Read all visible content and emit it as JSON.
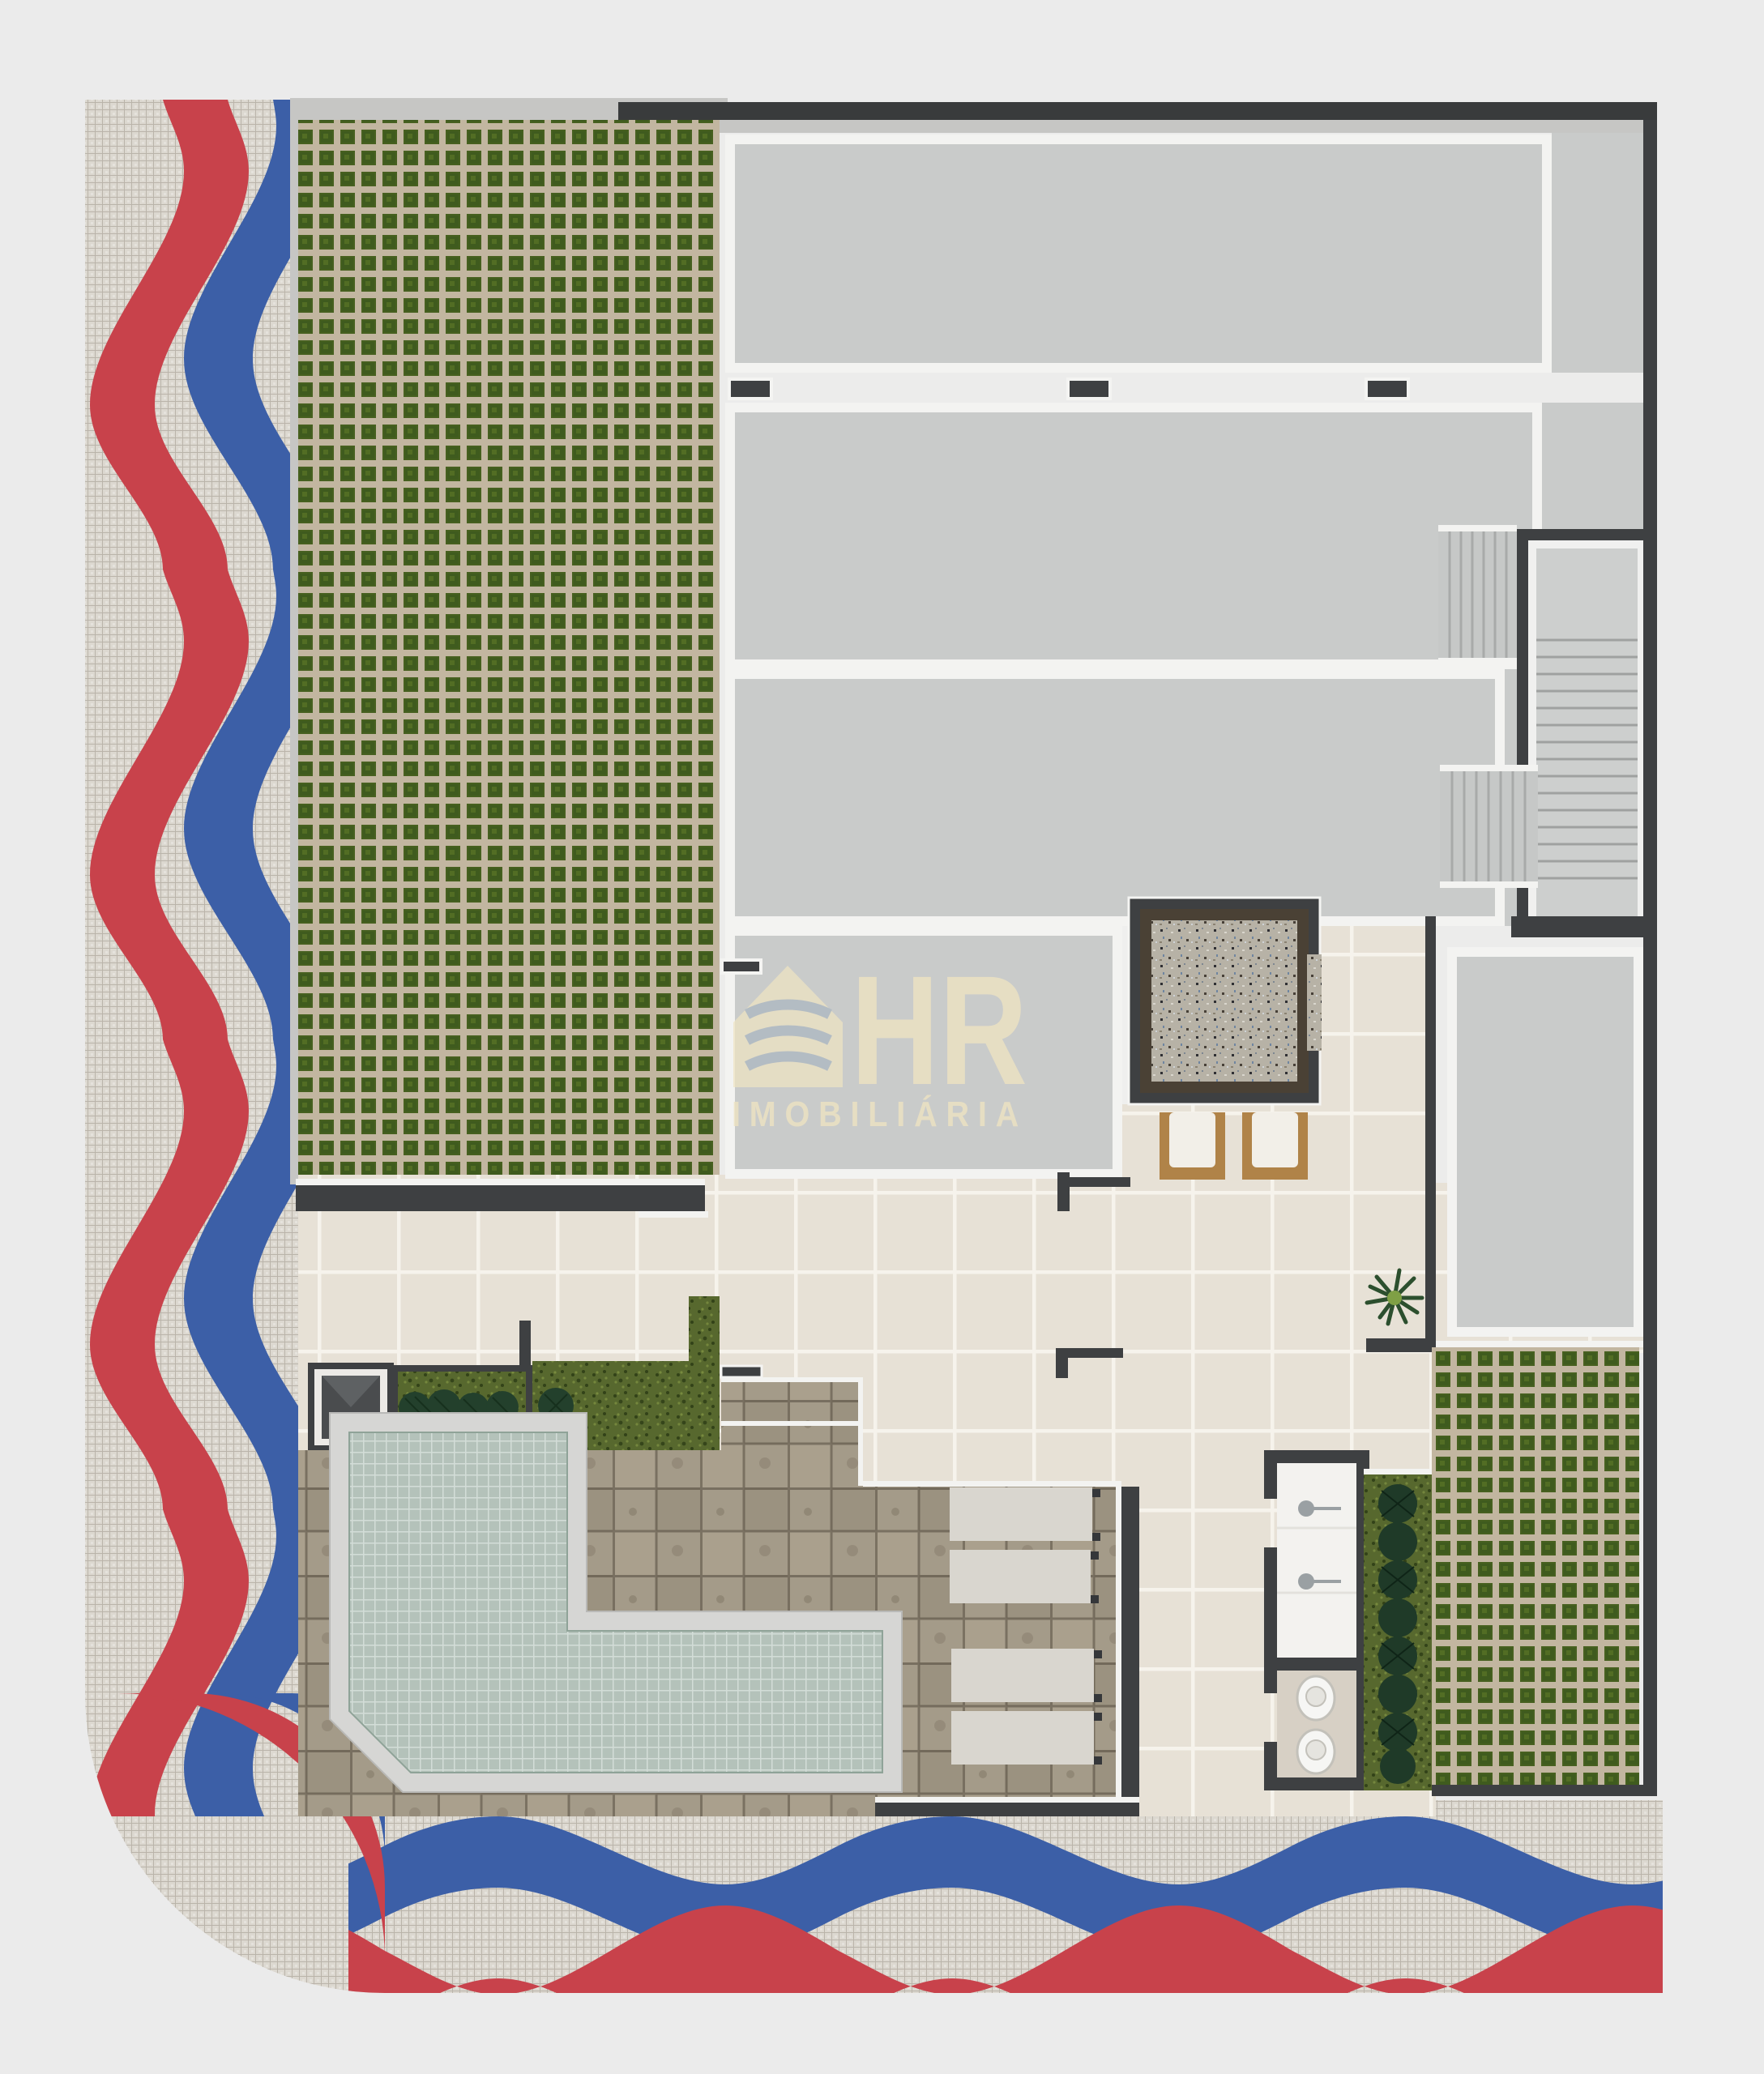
{
  "watermark": {
    "brand": "HR",
    "subtitle": "IMOBILIÁRIA"
  },
  "plan_type": "residential-building-site-plan-top-view",
  "palette": {
    "page_background": "#ebebeb",
    "mosaic_white": "#dcd8d0",
    "mosaic_red": "#c8424b",
    "mosaic_blue": "#3c5fa7",
    "grass_paver_tan": "#c2b6a0",
    "grass_paver_green": "#46601f",
    "concrete_slab": "#c9cbca",
    "white_trim": "#f3f3f1",
    "dark_wall": "#3e4042",
    "cream_tile": "#e7e1d6",
    "deck_stone": "#a49b89",
    "pool_water": "#b4c2ba",
    "pool_coping": "#d6d6d4",
    "granite_floor": "#b7b2a6",
    "planter_grass": "#57682e",
    "wood_chair": "#b08348",
    "watermark_cream": "#eee3c2"
  },
  "areas": [
    {
      "name": "copacabana-sidewalk",
      "desc": "portuguese mosaic with red and blue waves"
    },
    {
      "name": "grass-paver-garden-left",
      "desc": "large permeable paver lawn"
    },
    {
      "name": "building-roof-slabs",
      "desc": "concrete slabs with white trim"
    },
    {
      "name": "stair-core",
      "desc": "enclosed staircase with treads"
    },
    {
      "name": "entrance-lobby",
      "desc": "granite floor lobby with armchairs"
    },
    {
      "name": "pool",
      "desc": "L-shaped swimming pool"
    },
    {
      "name": "pool-deck",
      "desc": "stone paver deck with sun loungers"
    },
    {
      "name": "bath-block",
      "desc": "showers and toilets"
    },
    {
      "name": "grass-paver-garden-right",
      "desc": "permeable paver lawn"
    },
    {
      "name": "palm-planter",
      "desc": "vertical planter with palms"
    }
  ],
  "counts": {
    "sun_loungers": 4,
    "armchairs": 2,
    "toilets": 2,
    "showers": 2,
    "stair_flights": 3,
    "planters": 3,
    "windows": 4
  }
}
